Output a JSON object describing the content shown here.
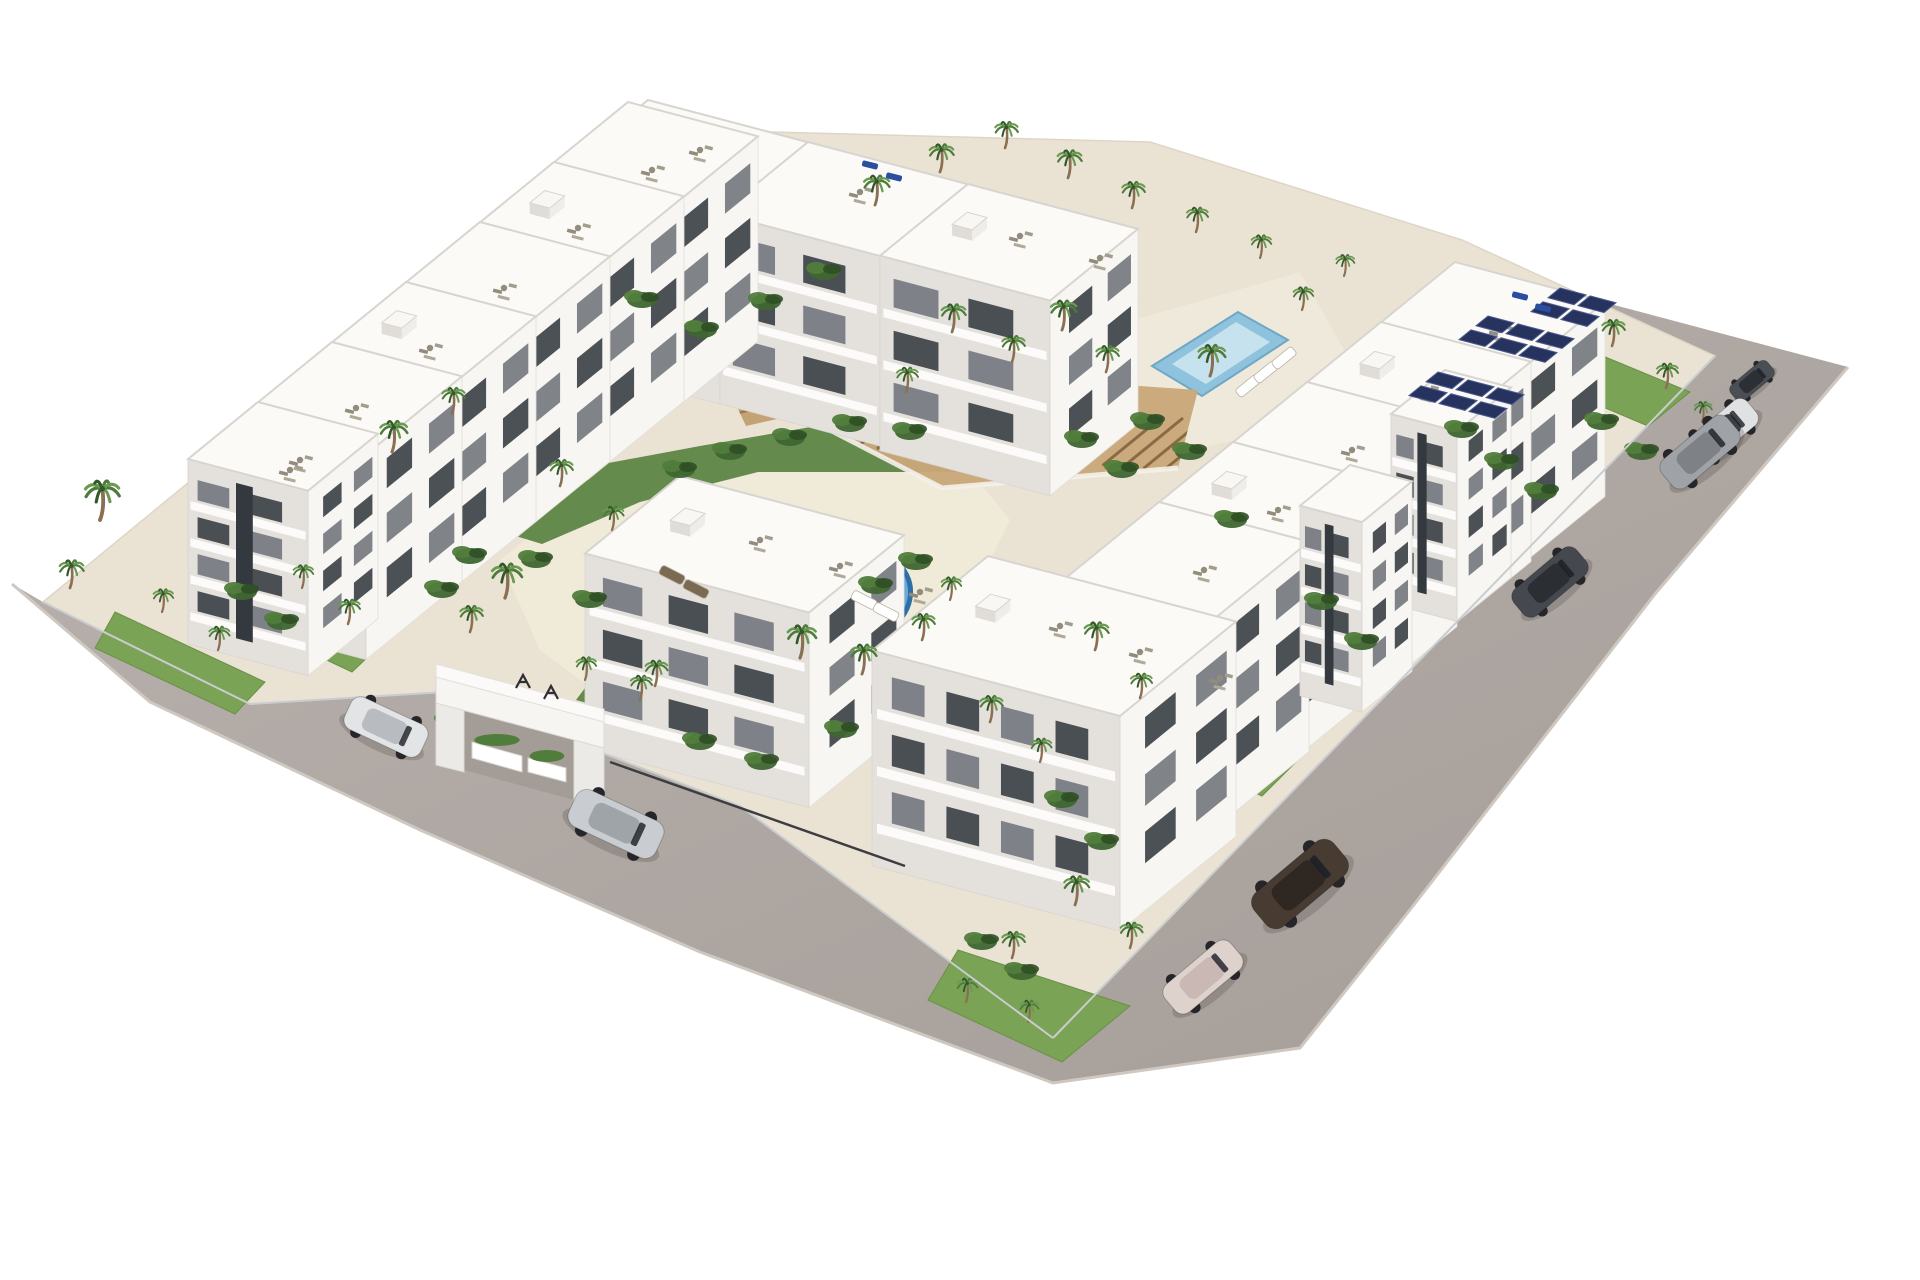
{
  "scene": {
    "description": "Aerial 3D architectural rendering of a white Mediterranean apartment complex with two swimming pools, palm-tree gardens, a wooden pergola, an entrance gate and cars parked on surrounding gray roads",
    "background": "#ffffff"
  },
  "palette": {
    "road": "#b6aeaa",
    "road_dark": "#a59d98",
    "curb": "#cfc8c1",
    "platform": "#eae3d4",
    "deck": "#f0ead9",
    "deck2": "#efe9dc",
    "lawn": "#7ba356",
    "lawn_edge": "#6a9147",
    "bed": "#55803d",
    "pool_edge": "#2f6fa7",
    "pool_water": "#5ea3d6",
    "pool_light": "#9ccbe8",
    "backpool": "#8fc2dc",
    "backpool_in": "#c6e2ef",
    "pergola_base": "#c9a87a",
    "pergola_slat": "#8a6a42",
    "pergola_edge": "#f4f1ea",
    "amph": "#c3a273",
    "amph_line": "#9a7b50",
    "wall_sun": "#f7f6f3",
    "wall_shade": "#e4e1dd",
    "roof": "#fbfaf7",
    "parapet": "#d8d5d0",
    "window": "#3d4248",
    "window_lt": "#757a80",
    "slab": "#fdfcfa",
    "fence": "#c9cdd0",
    "fence_dark": "#3e3e40",
    "solar": "#27335f",
    "solar_edge": "#4d5a8e",
    "trunk": "#8a6f52",
    "frond": "#4e7a3c",
    "frond_light": "#699a50",
    "frond_dark": "#32582a",
    "furniture": "#928c7d",
    "lounger_blue": "#2b4fa0",
    "gate_white": "#f6f5f2",
    "gate_shade": "#eceae6",
    "gate_open": "#a49c96",
    "gate_mark": "#2f2f33"
  },
  "road": {
    "outline": [
      [
        12,
        584
      ],
      [
        150,
        702
      ],
      [
        420,
        830
      ],
      [
        700,
        952
      ],
      [
        1053,
        1083
      ],
      [
        1300,
        1048
      ],
      [
        1413,
        906
      ],
      [
        1655,
        594
      ],
      [
        1848,
        367
      ],
      [
        1452,
        262
      ],
      [
        1715,
        356
      ],
      [
        1053,
        1038
      ],
      [
        740,
        806
      ],
      [
        600,
        752
      ],
      [
        445,
        692
      ],
      [
        250,
        704
      ],
      [
        43,
        602
      ]
    ],
    "curb": [
      [
        12,
        584
      ],
      [
        150,
        702
      ],
      [
        420,
        830
      ],
      [
        700,
        952
      ],
      [
        1053,
        1083
      ],
      [
        1300,
        1048
      ],
      [
        1413,
        906
      ],
      [
        1655,
        594
      ],
      [
        1848,
        367
      ]
    ]
  },
  "platform": {
    "outline": [
      [
        43,
        602
      ],
      [
        250,
        704
      ],
      [
        445,
        692
      ],
      [
        600,
        752
      ],
      [
        740,
        806
      ],
      [
        1053,
        1038
      ],
      [
        1715,
        356
      ],
      [
        1462,
        240
      ],
      [
        1150,
        142
      ],
      [
        620,
        128
      ]
    ]
  },
  "decks": [
    {
      "pts": [
        [
          1100,
          330
        ],
        [
          1300,
          272
        ],
        [
          1378,
          410
        ],
        [
          1178,
          452
        ]
      ],
      "key": "deck2"
    },
    {
      "pts": [
        [
          500,
          560
        ],
        [
          600,
          480
        ],
        [
          760,
          440
        ],
        [
          950,
          446
        ],
        [
          1010,
          520
        ],
        [
          950,
          640
        ],
        [
          860,
          700
        ],
        [
          760,
          744
        ],
        [
          640,
          724
        ],
        [
          540,
          650
        ]
      ],
      "key": "deck"
    }
  ],
  "lawns": [
    [
      [
        115,
        612
      ],
      [
        265,
        682
      ],
      [
        235,
        714
      ],
      [
        95,
        648
      ]
    ],
    [
      [
        1540,
        330
      ],
      [
        1690,
        392
      ],
      [
        1648,
        426
      ],
      [
        1506,
        366
      ]
    ],
    [
      [
        1282,
        560
      ],
      [
        1420,
        624
      ],
      [
        1380,
        668
      ],
      [
        1242,
        602
      ]
    ],
    [
      [
        1180,
        700
      ],
      [
        1302,
        756
      ],
      [
        1262,
        796
      ],
      [
        1140,
        742
      ]
    ],
    [
      [
        958,
        950
      ],
      [
        1130,
        1006
      ],
      [
        1062,
        1062
      ],
      [
        928,
        1000
      ]
    ],
    [
      [
        252,
        570
      ],
      [
        390,
        636
      ],
      [
        352,
        672
      ],
      [
        216,
        608
      ]
    ],
    [
      [
        900,
        200
      ],
      [
        1082,
        242
      ],
      [
        1042,
        286
      ],
      [
        860,
        246
      ]
    ]
  ],
  "garden_beds": [
    [
      [
        470,
        522
      ],
      [
        560,
        472
      ],
      [
        700,
        446
      ],
      [
        840,
        422
      ],
      [
        952,
        432
      ],
      [
        982,
        472
      ],
      [
        898,
        472
      ],
      [
        758,
        472
      ],
      [
        640,
        502
      ],
      [
        542,
        544
      ]
    ],
    [
      [
        600,
        668
      ],
      [
        668,
        688
      ],
      [
        640,
        718
      ],
      [
        576,
        700
      ]
    ]
  ],
  "pools": {
    "main": {
      "path": "M 664,636 C 658,598 678,580 714,574 C 748,568 752,552 786,544 C 824,535 874,540 897,562 C 920,584 912,616 886,631 C 860,646 848,649 838,667 C 824,693 790,704 754,700 C 714,695 671,676 664,636 Z",
      "highlight": {
        "cx": 840,
        "cy": 585,
        "rx": 40,
        "ry": 16,
        "rot": 14
      },
      "steps": {
        "cx": 687,
        "cy": 612,
        "rx": 15,
        "ry": 8
      }
    },
    "back": {
      "outer": [
        [
          1152,
          366
        ],
        [
          1238,
          312
        ],
        [
          1288,
          340
        ],
        [
          1202,
          396
        ]
      ],
      "inner": [
        [
          1172,
          364
        ],
        [
          1236,
          322
        ],
        [
          1270,
          342
        ],
        [
          1206,
          384
        ]
      ]
    }
  },
  "pergola": {
    "slab": [
      [
        830,
        430
      ],
      [
        876,
        368
      ],
      [
        1198,
        390
      ],
      [
        1178,
        468
      ],
      [
        942,
        488
      ]
    ],
    "edge": [
      [
        830,
        430
      ],
      [
        942,
        488
      ],
      [
        1178,
        468
      ]
    ],
    "slat_start": [
      836,
      446
    ],
    "slat_end": [
      1164,
      470
    ],
    "slat_count": 17,
    "slat_vec": [
      60,
      -49
    ]
  },
  "amphitheater": {
    "pts": [
      [
        702,
        332
      ],
      [
        862,
        296
      ],
      [
        906,
        390
      ],
      [
        746,
        426
      ]
    ],
    "lines": 6
  },
  "buildings": [
    {
      "t": [
        648,
        100
      ],
      "a": 160,
      "b": 88,
      "h": 190,
      "floors": 3,
      "bulk": true
    },
    {
      "t": [
        808,
        142
      ],
      "a": 160,
      "b": 88,
      "h": 190,
      "floors": 3
    },
    {
      "t": [
        968,
        184
      ],
      "a": 170,
      "b": 88,
      "h": 195,
      "floors": 3,
      "bulk": true
    },
    {
      "t": [
        628,
        102
      ],
      "a": 130,
      "b": 96,
      "h": 205,
      "floors": 3
    },
    {
      "t": [
        554,
        162
      ],
      "a": 130,
      "b": 96,
      "h": 205,
      "floors": 3,
      "bulk": true
    },
    {
      "t": [
        480,
        222
      ],
      "a": 130,
      "b": 96,
      "h": 205,
      "floors": 3
    },
    {
      "t": [
        406,
        282
      ],
      "a": 130,
      "b": 96,
      "h": 205,
      "floors": 3,
      "bulk": true
    },
    {
      "t": [
        332,
        342
      ],
      "a": 130,
      "b": 96,
      "h": 205,
      "floors": 3
    },
    {
      "t": [
        258,
        402
      ],
      "a": 120,
      "b": 70,
      "h": 185,
      "floors": 4,
      "stair": true
    },
    {
      "t": [
        1455,
        262
      ],
      "a": 150,
      "b": 96,
      "h": 195,
      "floors": 3
    },
    {
      "t": [
        1381,
        322
      ],
      "a": 150,
      "b": 96,
      "h": 200,
      "floors": 3,
      "bulk": true
    },
    {
      "t": [
        1307,
        382
      ],
      "a": 150,
      "b": 96,
      "h": 205,
      "floors": 3
    },
    {
      "t": [
        1233,
        442
      ],
      "a": 150,
      "b": 96,
      "h": 205,
      "floors": 3,
      "bulk": true
    },
    {
      "t": [
        1159,
        502
      ],
      "a": 150,
      "b": 96,
      "h": 210,
      "floors": 3
    },
    {
      "t": [
        1445,
        370
      ],
      "a": 66,
      "b": 54,
      "h": 190,
      "floors": 4,
      "stair": true
    },
    {
      "t": [
        1350,
        465
      ],
      "a": 62,
      "b": 50,
      "h": 190,
      "floors": 4,
      "stair": true
    },
    {
      "t": [
        680,
        476
      ],
      "a": 224,
      "b": 95,
      "h": 195,
      "floors": 3,
      "bulk": true
    },
    {
      "t": [
        988,
        556
      ],
      "a": 248,
      "b": 116,
      "h": 215,
      "floors": 3,
      "bulk": true
    }
  ],
  "solar_clusters": [
    {
      "o": [
        1488,
        316
      ],
      "rows": 2,
      "cols": 3
    },
    {
      "o": [
        1438,
        372
      ],
      "rows": 2,
      "cols": 3
    },
    {
      "o": [
        1560,
        288
      ],
      "rows": 2,
      "cols": 2
    }
  ],
  "roof_furniture": [
    [
      652,
      170
    ],
    [
      578,
      228
    ],
    [
      504,
      288
    ],
    [
      430,
      348
    ],
    [
      356,
      408
    ],
    [
      300,
      460
    ],
    [
      700,
      150
    ],
    [
      860,
      192
    ],
    [
      1020,
      236
    ],
    [
      1100,
      258
    ],
    [
      1500,
      330
    ],
    [
      1426,
      390
    ],
    [
      1352,
      450
    ],
    [
      1278,
      510
    ],
    [
      1204,
      570
    ],
    [
      760,
      540
    ],
    [
      840,
      566
    ],
    [
      920,
      592
    ],
    [
      1060,
      626
    ],
    [
      1140,
      652
    ],
    [
      1220,
      678
    ],
    [
      290,
      470
    ]
  ],
  "roof_loungers": [
    [
      870,
      165
    ],
    [
      894,
      177
    ],
    [
      1520,
      296
    ],
    [
      1543,
      308
    ]
  ],
  "deck_loungers": [
    {
      "p": [
        672,
        575
      ],
      "rot": 27,
      "c": "#7b6a52"
    },
    {
      "p": [
        696,
        589
      ],
      "rot": 27,
      "c": "#7b6a52"
    },
    {
      "p": [
        864,
        600
      ],
      "rot": 27,
      "c": "#ffffff"
    },
    {
      "p": [
        886,
        612
      ],
      "rot": 27,
      "c": "#ffffff"
    },
    {
      "p": [
        1248,
        386
      ],
      "rot": -39,
      "c": "#ffffff"
    },
    {
      "p": [
        1266,
        372
      ],
      "rot": -39,
      "c": "#ffffff"
    },
    {
      "p": [
        1284,
        358
      ],
      "rot": -39,
      "c": "#ffffff"
    }
  ],
  "palms": [
    [
      100,
      520,
      1.2
    ],
    [
      70,
      588,
      0.85
    ],
    [
      162,
      612,
      0.7
    ],
    [
      218,
      650,
      0.72
    ],
    [
      302,
      588,
      0.7
    ],
    [
      348,
      624,
      0.75
    ],
    [
      392,
      452,
      0.95
    ],
    [
      452,
      414,
      0.8
    ],
    [
      560,
      486,
      0.8
    ],
    [
      612,
      530,
      0.72
    ],
    [
      505,
      598,
      1.05
    ],
    [
      470,
      632,
      0.8
    ],
    [
      585,
      680,
      0.7
    ],
    [
      640,
      700,
      0.75
    ],
    [
      800,
      658,
      1.0
    ],
    [
      862,
      674,
      0.9
    ],
    [
      922,
      640,
      0.8
    ],
    [
      950,
      600,
      0.7
    ],
    [
      655,
      686,
      0.78
    ],
    [
      875,
      205,
      0.9
    ],
    [
      940,
      172,
      0.85
    ],
    [
      1005,
      148,
      0.8
    ],
    [
      1068,
      178,
      0.85
    ],
    [
      1132,
      208,
      0.8
    ],
    [
      1196,
      232,
      0.75
    ],
    [
      1260,
      258,
      0.7
    ],
    [
      952,
      332,
      0.85
    ],
    [
      1012,
      362,
      0.8
    ],
    [
      906,
      392,
      0.75
    ],
    [
      1062,
      330,
      0.9
    ],
    [
      1106,
      372,
      0.8
    ],
    [
      1210,
      376,
      0.95
    ],
    [
      1302,
      310,
      0.7
    ],
    [
      1344,
      276,
      0.65
    ],
    [
      1612,
      346,
      0.8
    ],
    [
      1666,
      388,
      0.75
    ],
    [
      1702,
      422,
      0.62
    ],
    [
      1095,
      650,
      0.85
    ],
    [
      1140,
      698,
      0.75
    ],
    [
      990,
      722,
      0.8
    ],
    [
      1040,
      762,
      0.72
    ],
    [
      1075,
      905,
      0.88
    ],
    [
      1130,
      948,
      0.78
    ],
    [
      1012,
      958,
      0.8
    ],
    [
      966,
      1002,
      0.72
    ],
    [
      1028,
      1022,
      0.66
    ]
  ],
  "shrubs": [
    [
      524,
      700
    ],
    [
      562,
      728
    ],
    [
      700,
      742
    ],
    [
      762,
      762
    ],
    [
      842,
      730
    ],
    [
      470,
      556
    ],
    [
      442,
      590
    ],
    [
      876,
      586
    ],
    [
      916,
      562
    ],
    [
      1148,
      422
    ],
    [
      1190,
      452
    ],
    [
      1082,
      440
    ],
    [
      1122,
      470
    ],
    [
      1232,
      520
    ],
    [
      642,
      300
    ],
    [
      702,
      330
    ],
    [
      766,
      302
    ],
    [
      824,
      272
    ],
    [
      1462,
      430
    ],
    [
      1502,
      462
    ],
    [
      1542,
      492
    ],
    [
      1322,
      602
    ],
    [
      1362,
      642
    ],
    [
      1602,
      422
    ],
    [
      1642,
      452
    ],
    [
      242,
      592
    ],
    [
      282,
      622
    ],
    [
      1062,
      800
    ],
    [
      1102,
      842
    ],
    [
      982,
      942
    ],
    [
      1022,
      972
    ],
    [
      452,
      722
    ],
    [
      492,
      746
    ],
    [
      536,
      560
    ],
    [
      590,
      600
    ],
    [
      680,
      470
    ],
    [
      730,
      452
    ],
    [
      790,
      438
    ],
    [
      850,
      424
    ],
    [
      910,
      432
    ]
  ],
  "fences": [
    {
      "a": [
        43,
        602
      ],
      "b": [
        250,
        704
      ],
      "k": "fence"
    },
    {
      "a": [
        250,
        704
      ],
      "b": [
        445,
        692
      ],
      "k": "fence"
    },
    {
      "a": [
        600,
        752
      ],
      "b": [
        740,
        806
      ],
      "k": "fence"
    },
    {
      "a": [
        740,
        806
      ],
      "b": [
        1053,
        1038
      ],
      "k": "fence"
    },
    {
      "a": [
        1053,
        1038
      ],
      "b": [
        1715,
        356
      ],
      "k": "fence"
    },
    {
      "a": [
        610,
        762
      ],
      "b": [
        905,
        866
      ],
      "k": "fence_dark"
    }
  ],
  "gate": {
    "beam_top": [
      [
        436,
        664
      ],
      [
        604,
        709
      ],
      [
        604,
        722
      ],
      [
        436,
        677
      ]
    ],
    "beam": [
      [
        436,
        677
      ],
      [
        604,
        722
      ],
      [
        604,
        748
      ],
      [
        436,
        703
      ]
    ],
    "pillar_l": [
      [
        436,
        703
      ],
      [
        464,
        710
      ],
      [
        464,
        772
      ],
      [
        436,
        765
      ]
    ],
    "pillar_r": [
      [
        574,
        740
      ],
      [
        604,
        748
      ],
      [
        604,
        810
      ],
      [
        574,
        802
      ]
    ],
    "opening": [
      [
        464,
        710
      ],
      [
        574,
        740
      ],
      [
        574,
        800
      ],
      [
        464,
        770
      ]
    ],
    "planters": [
      [
        [
          472,
          742
        ],
        [
          522,
          756
        ],
        [
          522,
          772
        ],
        [
          472,
          758
        ]
      ],
      [
        [
          528,
          758
        ],
        [
          566,
          768
        ],
        [
          566,
          782
        ],
        [
          528,
          772
        ]
      ]
    ],
    "marks": [
      [
        516,
        688
      ],
      [
        544,
        699
      ]
    ]
  },
  "cars": [
    {
      "p": [
        386,
        727
      ],
      "len": 84,
      "rot": 25,
      "body": "#e2e4e6",
      "roof": "#b8bcc0"
    },
    {
      "p": [
        616,
        824
      ],
      "len": 96,
      "rot": 25,
      "body": "#c9ccd0",
      "roof": "#9fa4a8"
    },
    {
      "p": [
        1752,
        381
      ],
      "len": 48,
      "rot": -40,
      "body": "#4a4e55",
      "roof": "#2c2f34"
    },
    {
      "p": [
        1722,
        432
      ],
      "len": 78,
      "rot": -40,
      "body": "#e0e1e3",
      "roof": "#3c4046"
    },
    {
      "p": [
        1700,
        452
      ],
      "len": 86,
      "rot": -40,
      "body": "#9fa3a8",
      "roof": "#7e8287"
    },
    {
      "p": [
        1550,
        582
      ],
      "len": 82,
      "rot": -40,
      "body": "#45484e",
      "roof": "#2b2e33"
    },
    {
      "p": [
        1300,
        884
      ],
      "len": 104,
      "rot": -40,
      "body": "#473b32",
      "roof": "#2f2722"
    },
    {
      "p": [
        1203,
        977
      ],
      "len": 86,
      "rot": -40,
      "body": "#ded2cd",
      "roof": "#c9b8b4"
    }
  ]
}
